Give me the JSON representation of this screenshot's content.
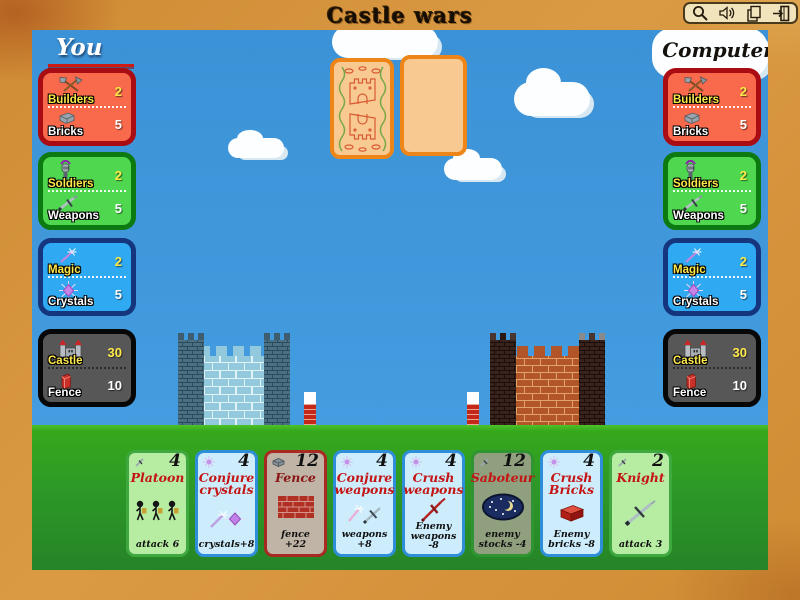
{
  "title": "Castle wars",
  "toolbar": {
    "buttons": [
      {
        "icon": "magnifier"
      },
      {
        "icon": "speaker"
      },
      {
        "icon": "pages"
      },
      {
        "icon": "exit-door"
      }
    ]
  },
  "players": {
    "you": {
      "label": "You",
      "panels": [
        {
          "top_label": "Builders",
          "top_value": "2",
          "bottom_label": "Bricks",
          "bottom_value": "5"
        },
        {
          "top_label": "Soldiers",
          "top_value": "2",
          "bottom_label": "Weapons",
          "bottom_value": "5"
        },
        {
          "top_label": "Magic",
          "top_value": "2",
          "bottom_label": "Crystals",
          "bottom_value": "5"
        },
        {
          "top_label": "Castle",
          "top_value": "30",
          "bottom_label": "Fence",
          "bottom_value": "10"
        }
      ]
    },
    "computer": {
      "label": "Computer",
      "panels": [
        {
          "top_label": "Builders",
          "top_value": "2",
          "bottom_label": "Bricks",
          "bottom_value": "5"
        },
        {
          "top_label": "Soldiers",
          "top_value": "2",
          "bottom_label": "Weapons",
          "bottom_value": "5"
        },
        {
          "top_label": "Magic",
          "top_value": "2",
          "bottom_label": "Crystals",
          "bottom_value": "5"
        },
        {
          "top_label": "Castle",
          "top_value": "30",
          "bottom_label": "Fence",
          "bottom_value": "10"
        }
      ]
    }
  },
  "hand": {
    "cards": [
      {
        "name": "Platoon",
        "cost": "4",
        "effect": "attack 6",
        "cost_icon": "sword",
        "art": "three-soldiers"
      },
      {
        "name": "Conjure crystals",
        "cost": "4",
        "effect": "crystals+8",
        "cost_icon": "crystal",
        "art": "wand-and-crystal"
      },
      {
        "name": "Fence",
        "cost": "12",
        "effect": "fence +22",
        "cost_icon": "brick",
        "art": "brick-wall"
      },
      {
        "name": "Conjure weapons",
        "cost": "4",
        "effect": "weapons +8",
        "cost_icon": "crystal",
        "art": "wand-and-sword"
      },
      {
        "name": "Crush weapons",
        "cost": "4",
        "effect": "Enemy weapons -8",
        "cost_icon": "crystal",
        "art": "red-sword"
      },
      {
        "name": "Saboteur",
        "cost": "12",
        "effect": "enemy stocks -4",
        "cost_icon": "sword",
        "art": "night-moon"
      },
      {
        "name": "Crush Bricks",
        "cost": "4",
        "effect": "Enemy bricks -8",
        "cost_icon": "crystal",
        "art": "red-brick"
      },
      {
        "name": "Knight",
        "cost": "2",
        "effect": "attack 3",
        "cost_icon": "sword",
        "art": "sword"
      }
    ]
  },
  "colors": {
    "frame": "#CE8C34",
    "sky": "#3C92D6",
    "grass": "#2D9827",
    "panel_red": "#F9694B",
    "panel_green": "#4FD84F",
    "panel_blue": "#2FA9F2",
    "panel_dark": "#575757",
    "value_yellow": "#FFE94A",
    "value_white": "#FFFFFF",
    "card_title_red": "#C41414",
    "left_castle": "#93C9DC",
    "right_castle": "#B2562A"
  }
}
